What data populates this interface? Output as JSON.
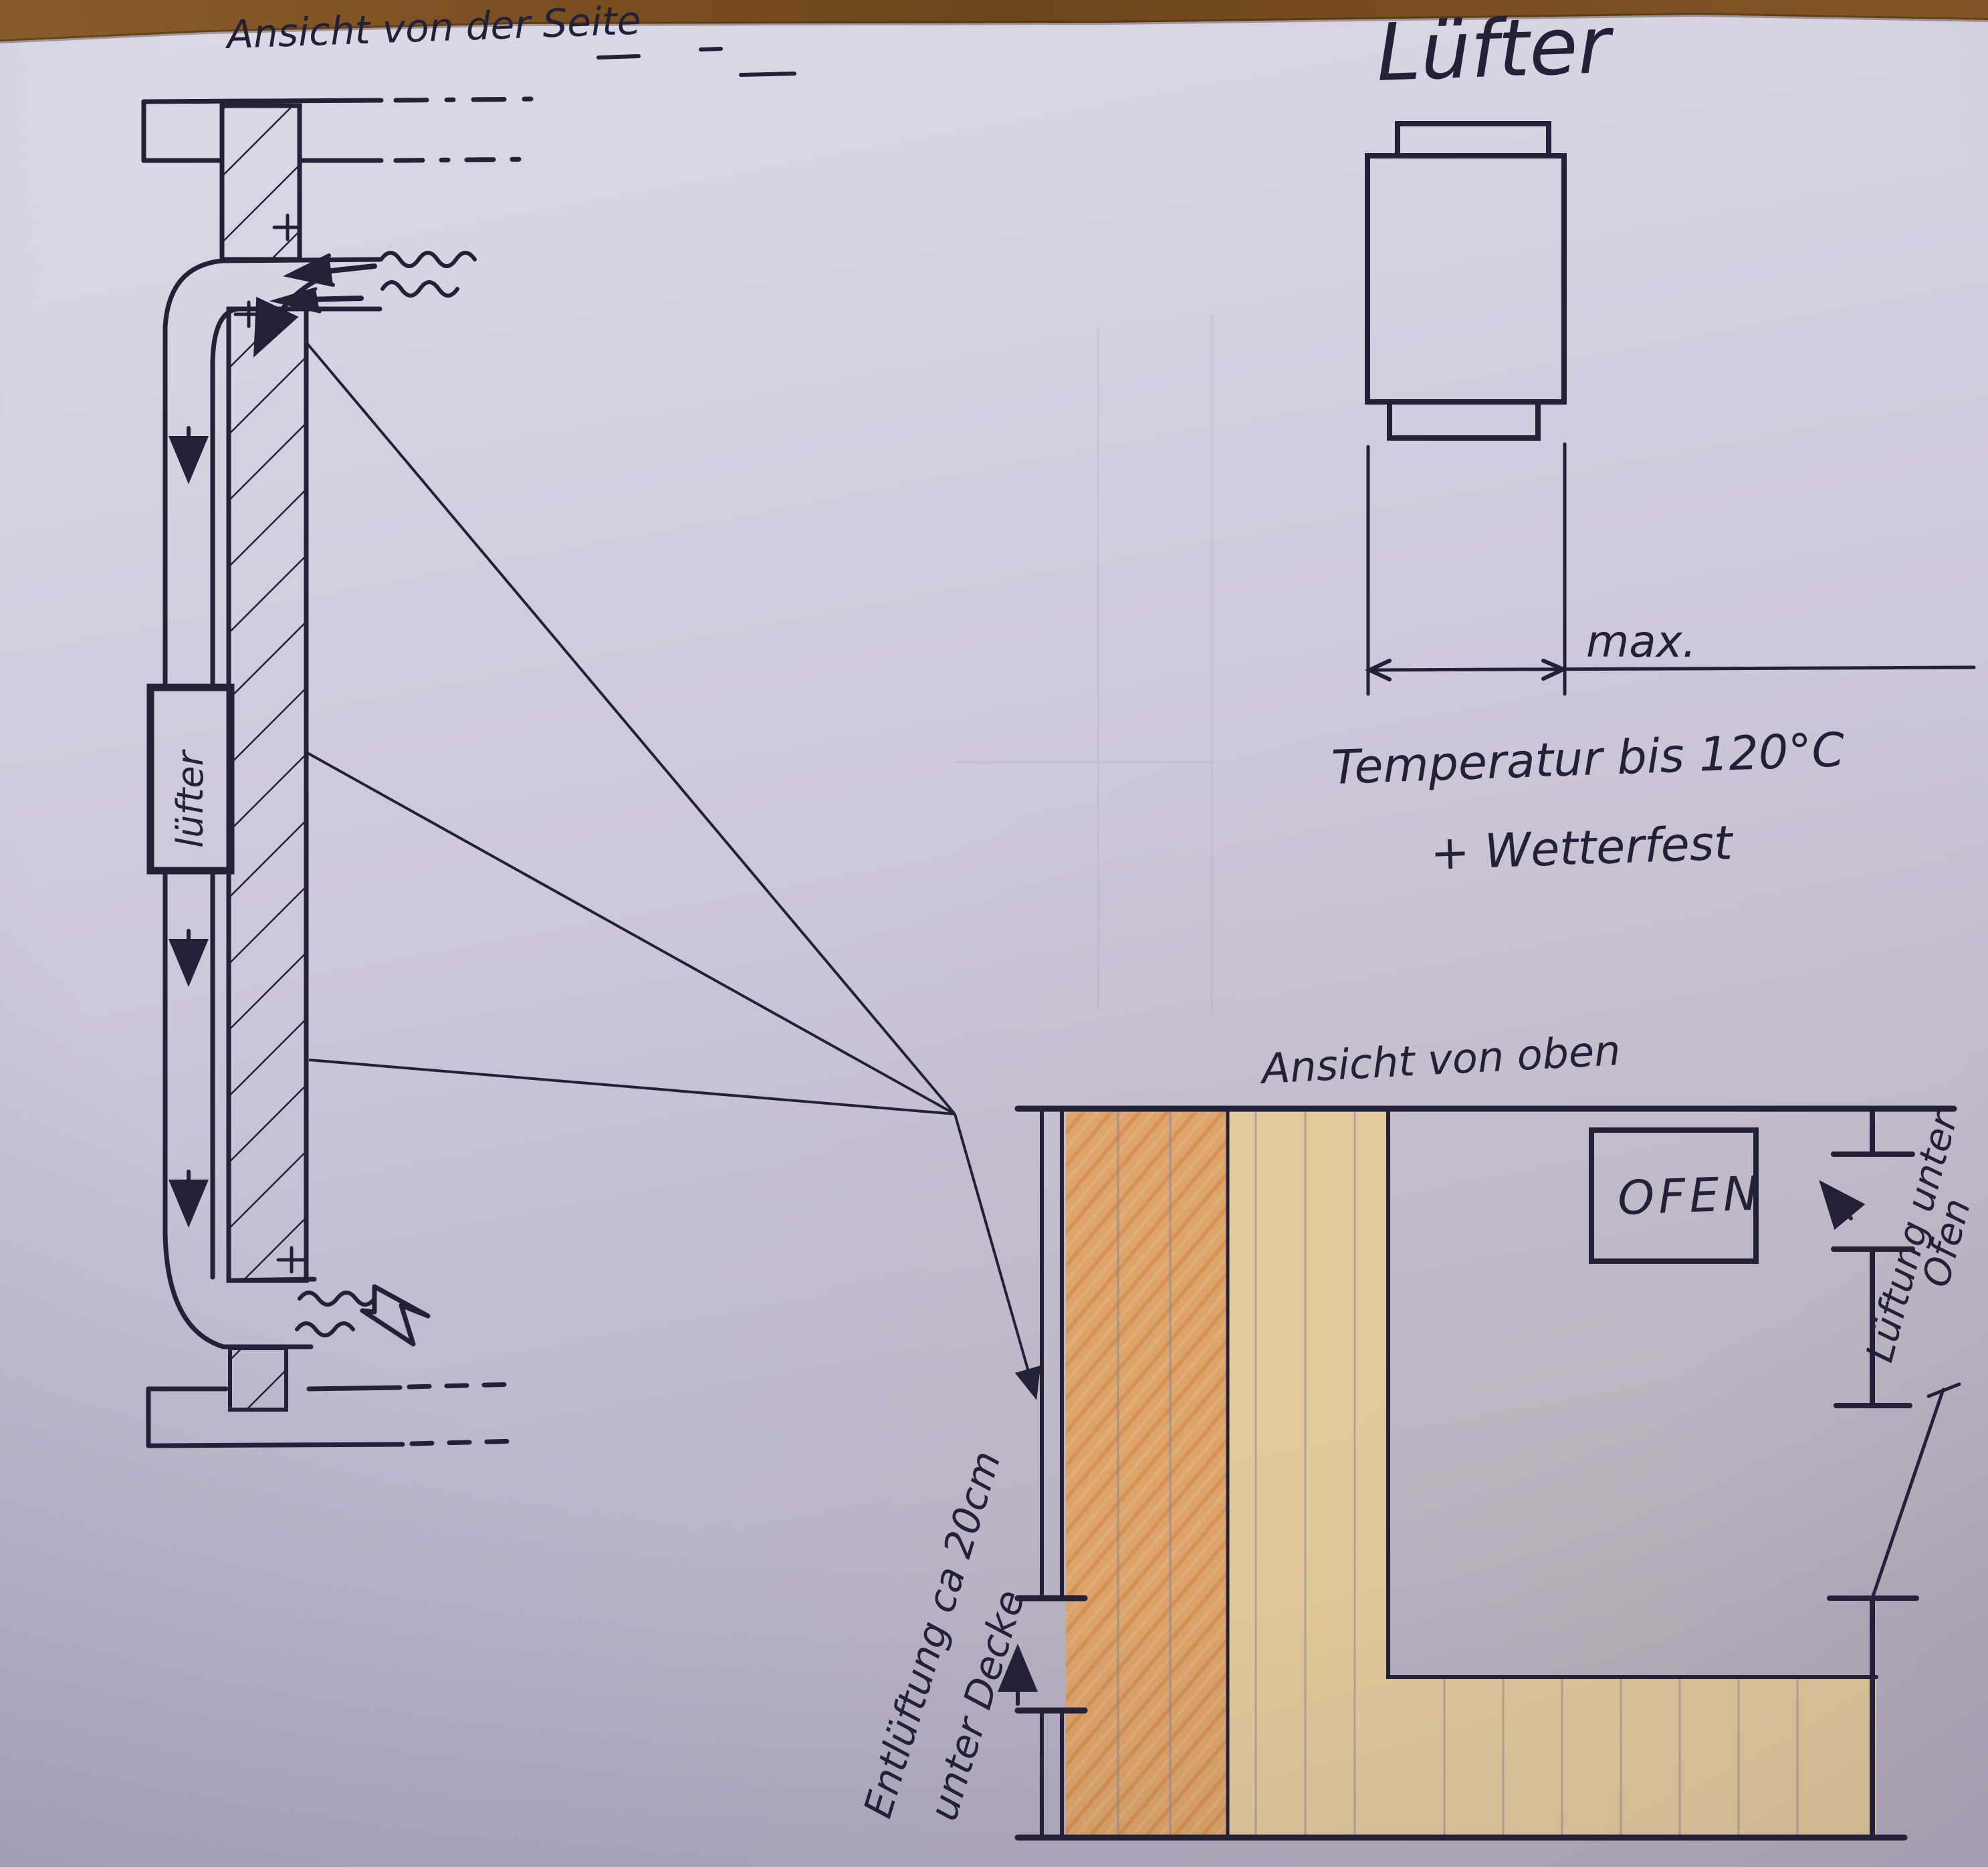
{
  "colors": {
    "paper": "#cdc8da",
    "ink": "#232138",
    "pencil": "#8b8598",
    "orange_wall": "#e0a262",
    "orange_scribble": "#cf8138",
    "tan_wood": "#e5ca96",
    "table_wood": "#7a4e20"
  },
  "side_view": {
    "title": "Ansicht von der Seite",
    "fan_box_label": "lüfter"
  },
  "fan_detail": {
    "title": "Lüfter",
    "dimension_label": "max.",
    "note_line1": "Temperatur bis 120°C",
    "note_line2": "+ Wetterfest"
  },
  "plan_view": {
    "title": "Ansicht von oben",
    "oven_label": "OFEN",
    "right_vent_label_line1": "Lüftung unter",
    "right_vent_label_line2": "Ofen",
    "left_vent_label_line1": "Entlüftung ca 20cm",
    "left_vent_label_line2": "unter Decke"
  }
}
